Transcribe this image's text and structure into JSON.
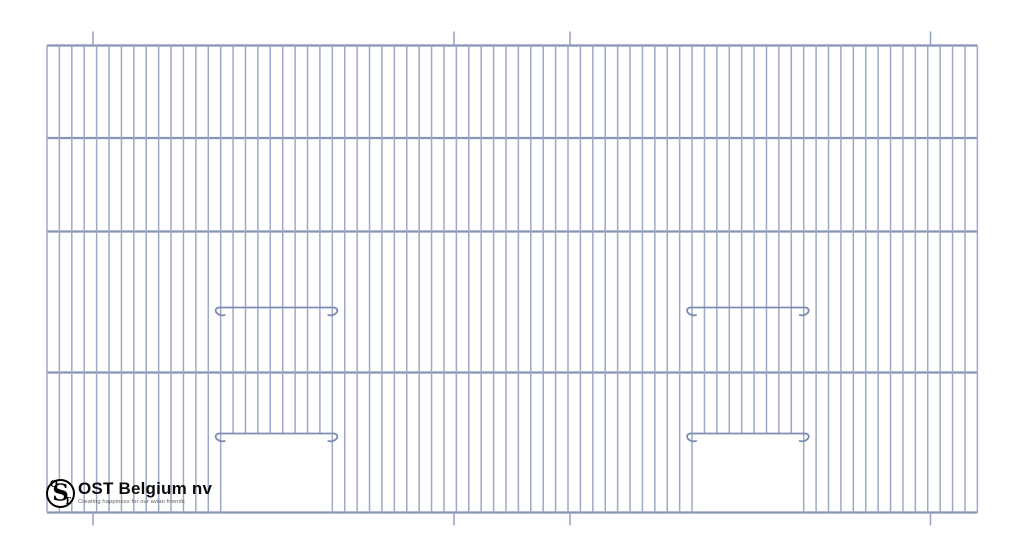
{
  "brand": {
    "name": "OST Belgium nv",
    "tagline": "Creating happiness for our avian friends",
    "monogram": {
      "o": "O",
      "s": "S",
      "t": "T"
    }
  },
  "drawing": {
    "canvas": {
      "width": 1024,
      "height": 559
    },
    "background": "#ffffff",
    "colors": {
      "vertical_wire": "#9fa9c6",
      "horizontal_wire": "#8694b6",
      "rail_wire": "#7d8db1",
      "stub_wire": "#93a0c0"
    },
    "panel": {
      "left": 47,
      "right": 977.4,
      "top": 45.5,
      "bottom": 512.5
    },
    "vertical_wires": {
      "count": 76,
      "pitch": 12.405,
      "stroke_width": 1.5
    },
    "horizontal_wires": {
      "y_positions": [
        45.5,
        138,
        231.5,
        372.5,
        512.5
      ],
      "stroke_width": 2.2
    },
    "hanging_stubs": {
      "x_positions": [
        93,
        454,
        570,
        930.5
      ],
      "top_start_y": 31.5,
      "bottom_end_y": 525.5,
      "stroke_width": 1.5
    },
    "doors": [
      {
        "left_wire_index": 14,
        "right_wire_index": 23,
        "upper_rail_y": 307.5,
        "door_rail_y": 433.5
      },
      {
        "left_wire_index": 52,
        "right_wire_index": 61,
        "upper_rail_y": 307.5,
        "door_rail_y": 433.5
      }
    ],
    "rail": {
      "overhang": 6,
      "stroke_width": 1.8,
      "curl_drop": 7.5
    }
  }
}
